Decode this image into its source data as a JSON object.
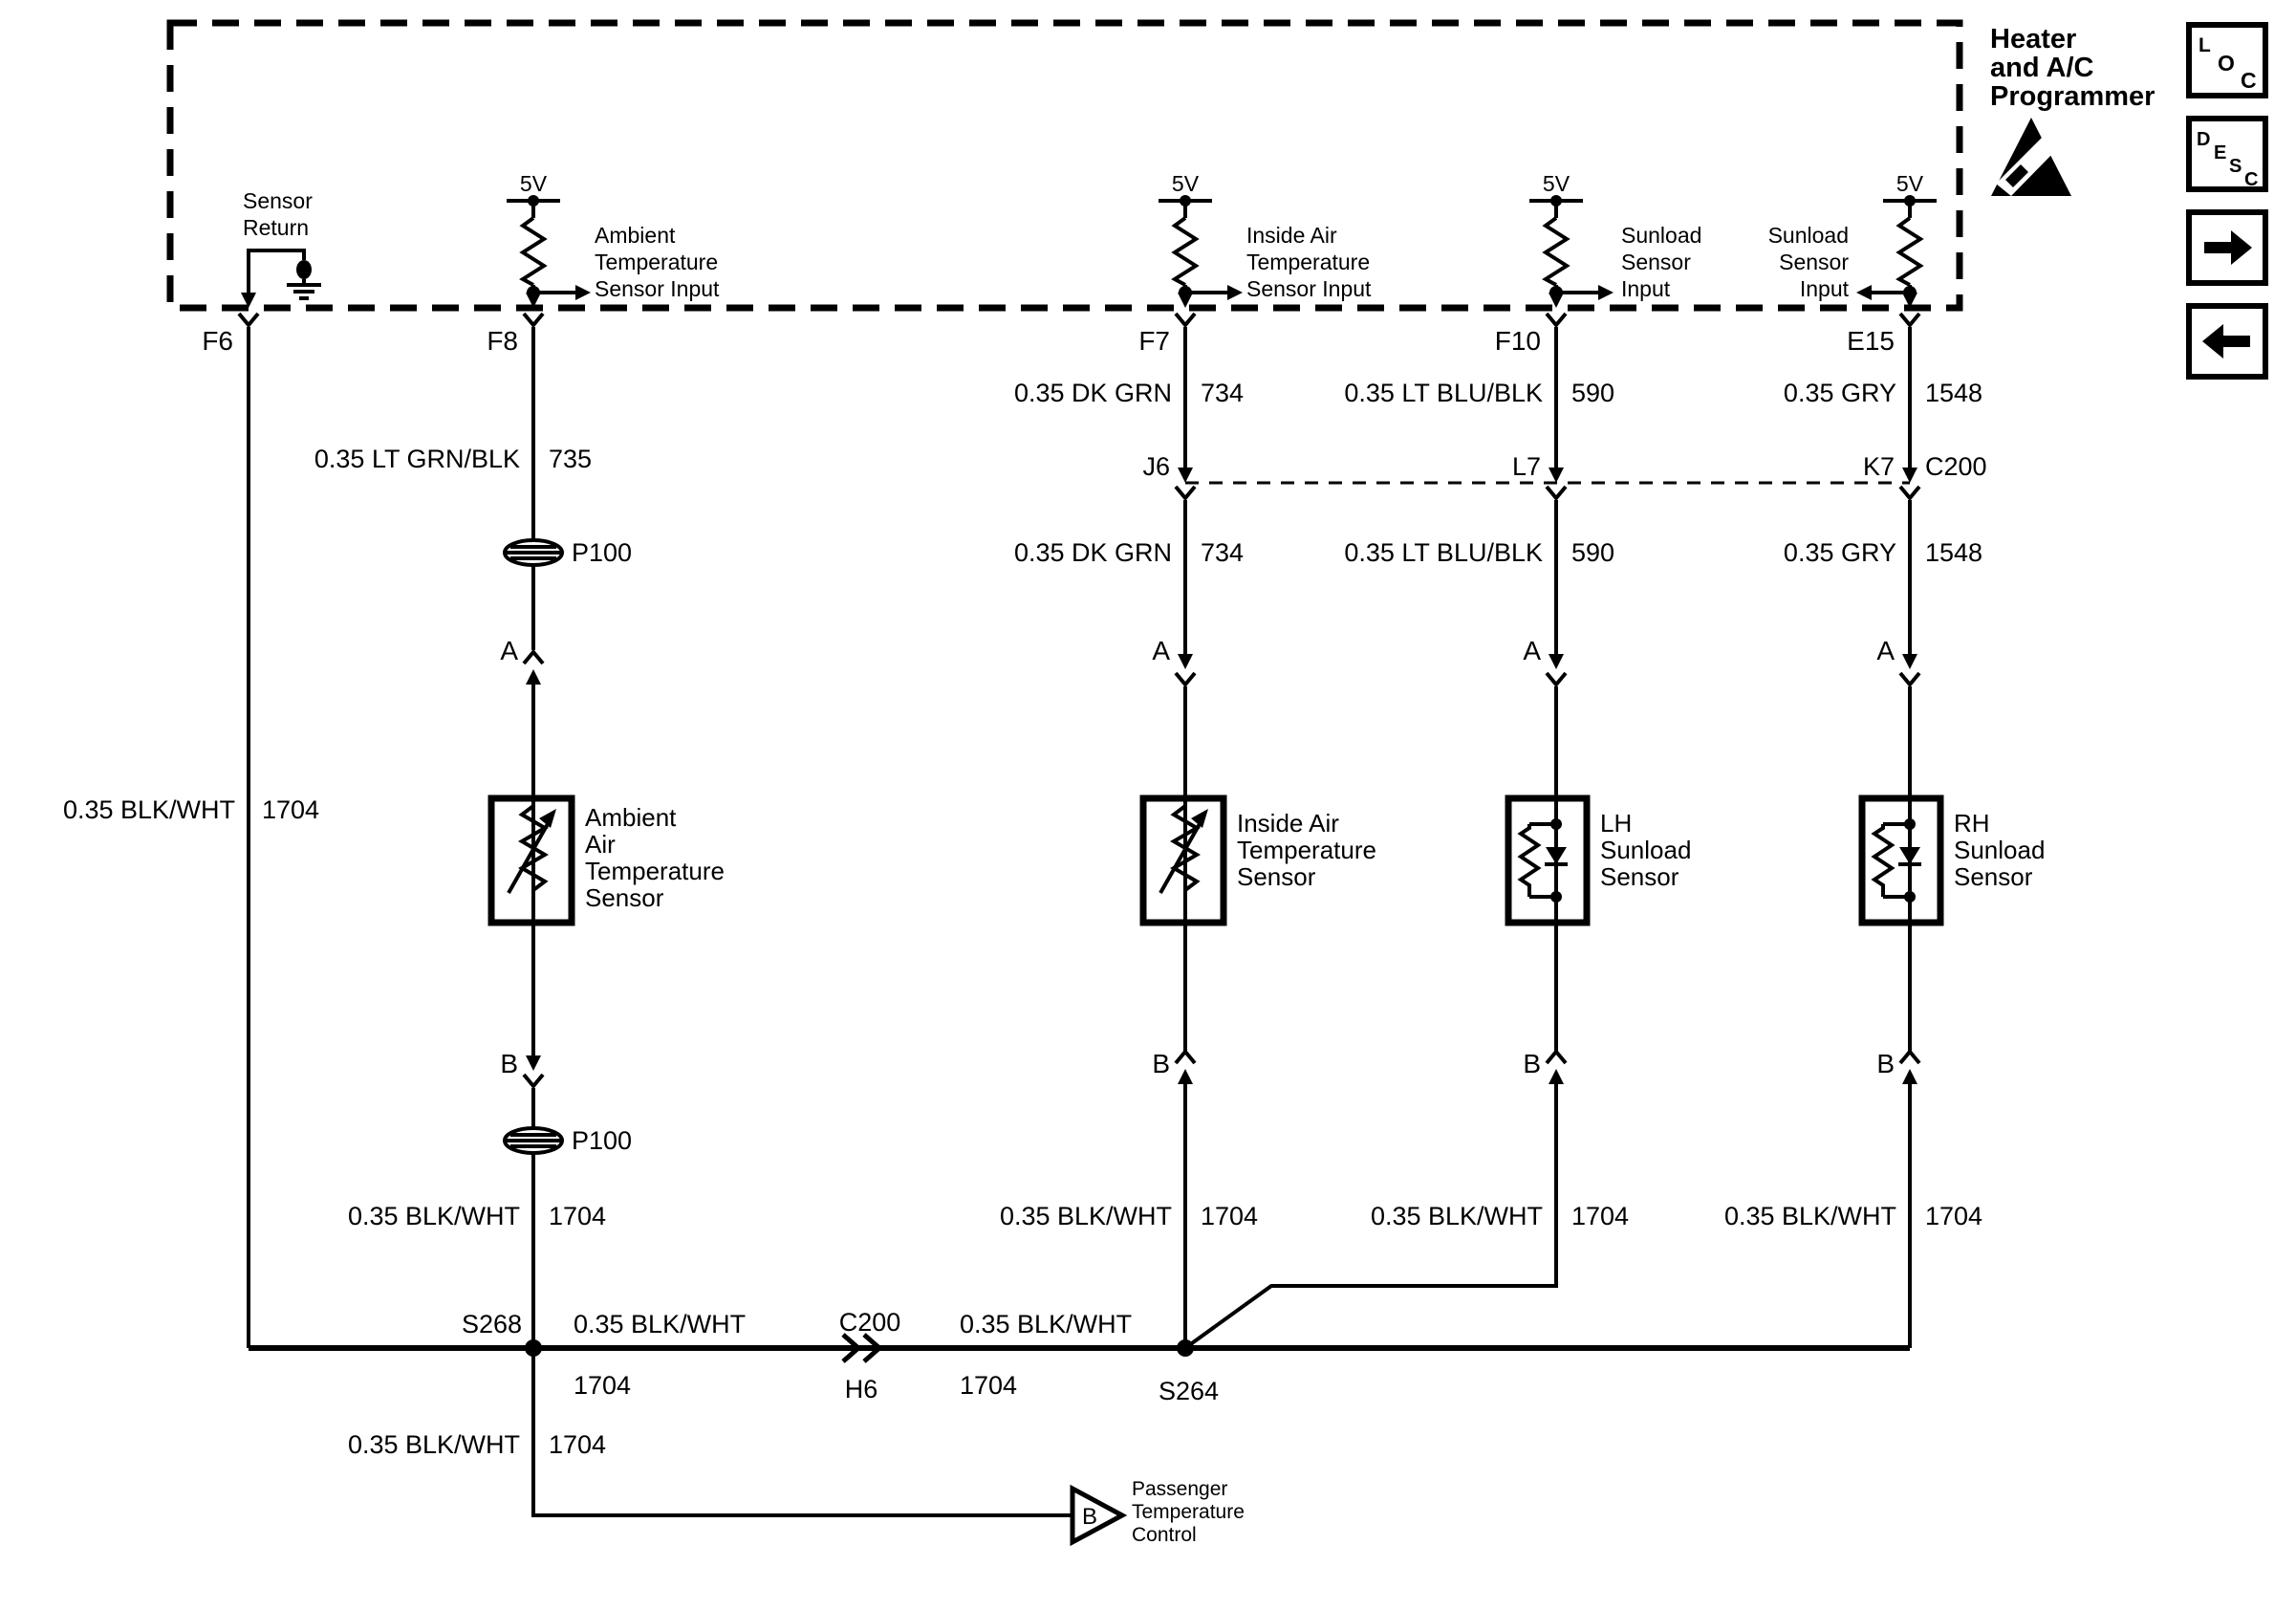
{
  "header": {
    "title_lines": [
      "Heater",
      "and A/C",
      "Programmer"
    ]
  },
  "nav": {
    "loc_letters": [
      "L",
      "O",
      "C"
    ],
    "desc_letters": [
      "D",
      "E",
      "S",
      "C"
    ]
  },
  "programmer": {
    "sensor_return_lines": [
      "Sensor",
      "Return"
    ],
    "supply": "5V",
    "ambient_input_lines": [
      "Ambient",
      "Temperature",
      "Sensor Input"
    ],
    "inside_air_input_lines": [
      "Inside Air",
      "Temperature",
      "Sensor Input"
    ],
    "lh_sunload_input_lines": [
      "Sunload",
      "Sensor",
      "Input"
    ],
    "rh_sunload_input_lines": [
      "Sunload",
      "Sensor",
      "Input"
    ]
  },
  "pins": {
    "f6": "F6",
    "f8": "F8",
    "f7": "F7",
    "f10": "F10",
    "e15": "E15"
  },
  "terminals": {
    "a": "A",
    "b": "B"
  },
  "inline_connectors": {
    "j6": "J6",
    "l7": "L7",
    "k7": "K7",
    "c200": "C200",
    "p100_upper": "P100",
    "p100_lower": "P100",
    "bus_c200": "C200",
    "bus_h6": "H6"
  },
  "splices": {
    "s268": "S268",
    "s264": "S264"
  },
  "wires": {
    "f6": {
      "color": "0.35 BLK/WHT",
      "circuit": "1704"
    },
    "f8_upper": {
      "color": "0.35 LT GRN/BLK",
      "circuit": "735"
    },
    "f8_lower": {
      "color": "0.35 BLK/WHT",
      "circuit": "1704"
    },
    "f7_upper": {
      "color": "0.35 DK GRN",
      "circuit": "734"
    },
    "f7_mid": {
      "color": "0.35 DK GRN",
      "circuit": "734"
    },
    "f7_lower": {
      "color": "0.35 BLK/WHT",
      "circuit": "1704"
    },
    "f10_upper": {
      "color": "0.35 LT BLU/BLK",
      "circuit": "590"
    },
    "f10_mid": {
      "color": "0.35 LT BLU/BLK",
      "circuit": "590"
    },
    "f10_lower": {
      "color": "0.35 BLK/WHT",
      "circuit": "1704"
    },
    "e15_upper": {
      "color": "0.35 GRY",
      "circuit": "1548"
    },
    "e15_mid": {
      "color": "0.35 GRY",
      "circuit": "1548"
    },
    "e15_lower": {
      "color": "0.35 BLK/WHT",
      "circuit": "1704"
    },
    "bus_left": {
      "color": "0.35 BLK/WHT",
      "circuit": "1704"
    },
    "bus_right": {
      "color": "0.35 BLK/WHT",
      "circuit": "1704"
    },
    "s268_drop": {
      "color": "0.35 BLK/WHT",
      "circuit": "1704"
    }
  },
  "components": {
    "ambient": [
      "Ambient",
      "Air",
      "Temperature",
      "Sensor"
    ],
    "inside_air": [
      "Inside Air",
      "Temperature",
      "Sensor"
    ],
    "lh_sunload": [
      "LH",
      "Sunload",
      "Sensor"
    ],
    "rh_sunload": [
      "RH",
      "Sunload",
      "Sensor"
    ]
  },
  "output": {
    "pin": "B",
    "lines": [
      "Passenger",
      "Temperature",
      "Control"
    ]
  },
  "colors": {
    "ink": "#000000",
    "background": "#ffffff"
  }
}
